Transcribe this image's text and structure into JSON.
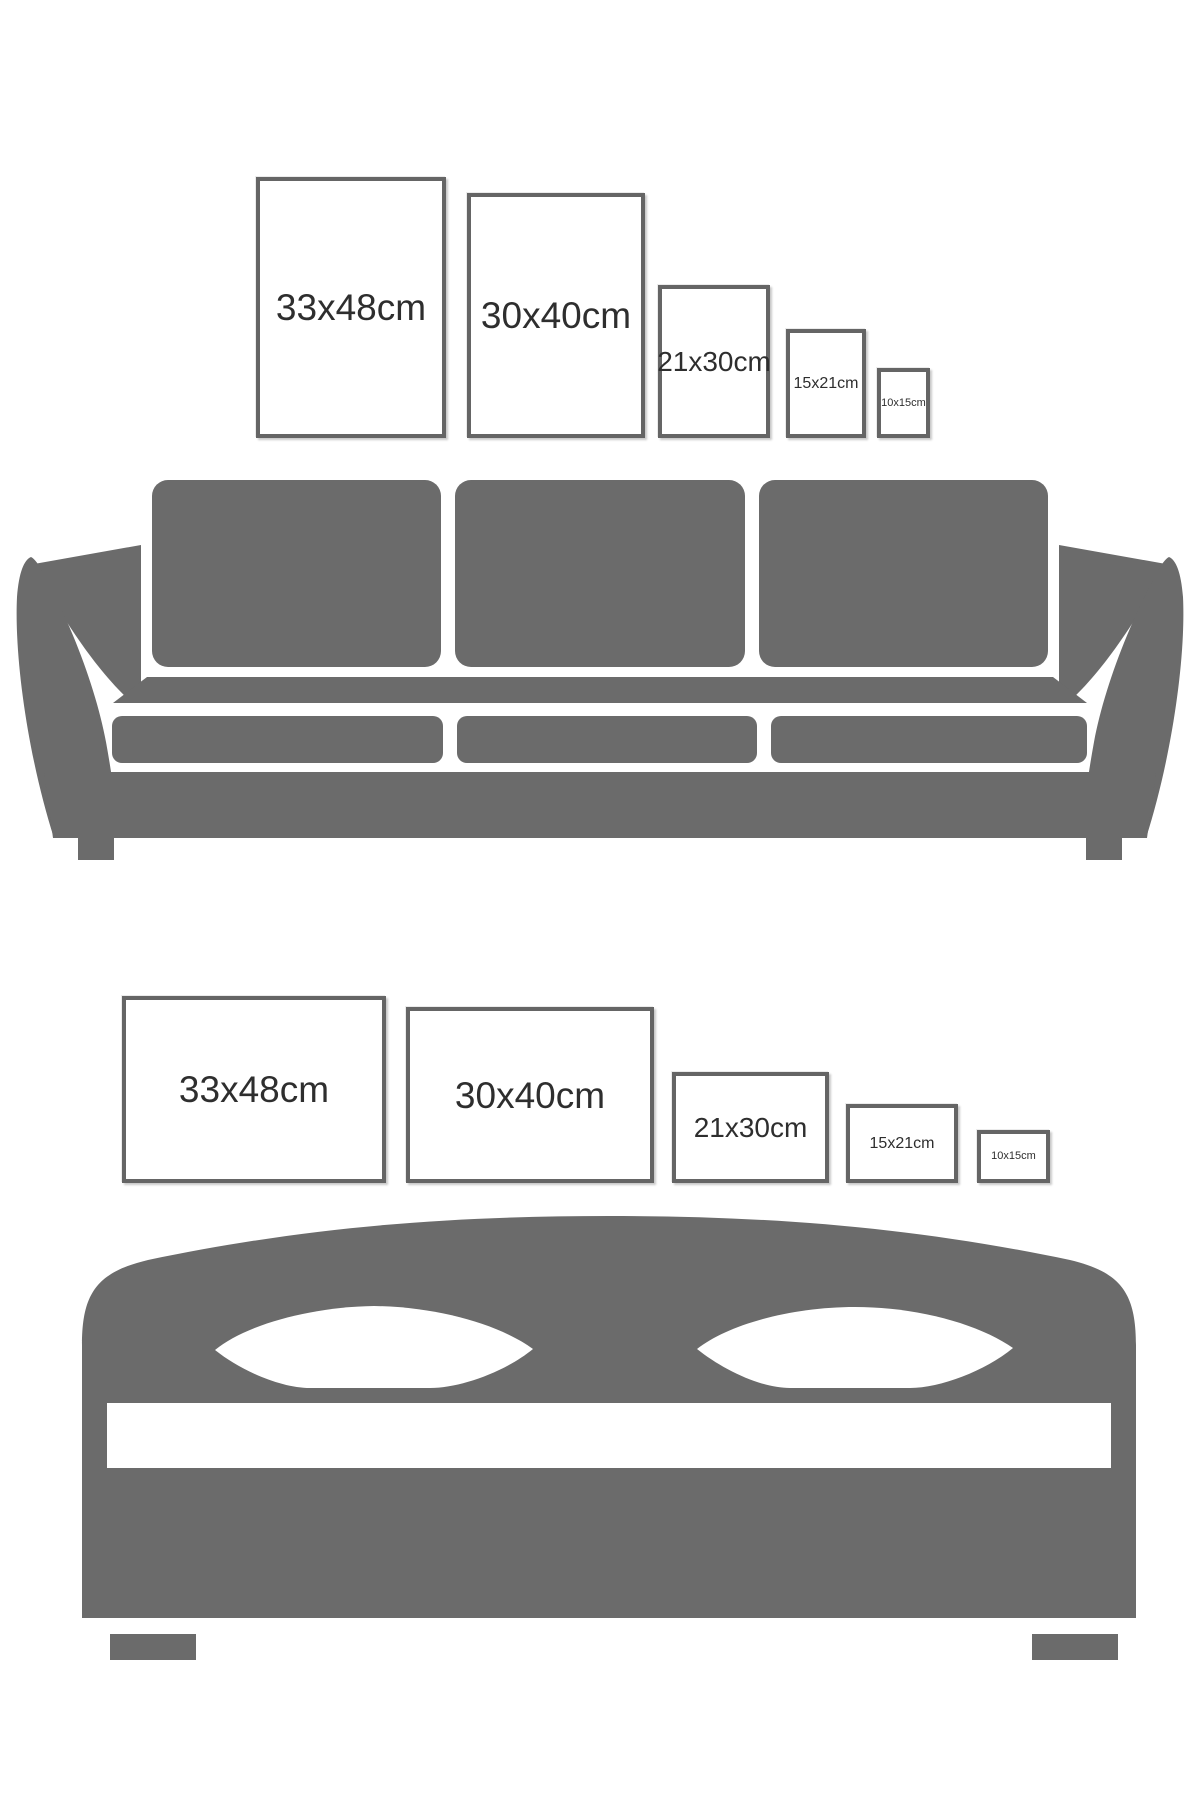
{
  "colors": {
    "furniture": "#6b6b6b",
    "frame_border": "#656565",
    "label_text": "#2e2e2e",
    "background": "#ffffff"
  },
  "sofa_section": {
    "illustration": "sofa-silhouette",
    "orientation": "portrait",
    "frames": [
      {
        "label": "33x48cm"
      },
      {
        "label": "30x40cm"
      },
      {
        "label": "21x30cm"
      },
      {
        "label": "15x21cm"
      },
      {
        "label": "10x15cm"
      }
    ]
  },
  "bed_section": {
    "illustration": "bed-silhouette",
    "orientation": "landscape",
    "frames": [
      {
        "label": "33x48cm"
      },
      {
        "label": "30x40cm"
      },
      {
        "label": "21x30cm"
      },
      {
        "label": "15x21cm"
      },
      {
        "label": "10x15cm"
      }
    ]
  }
}
